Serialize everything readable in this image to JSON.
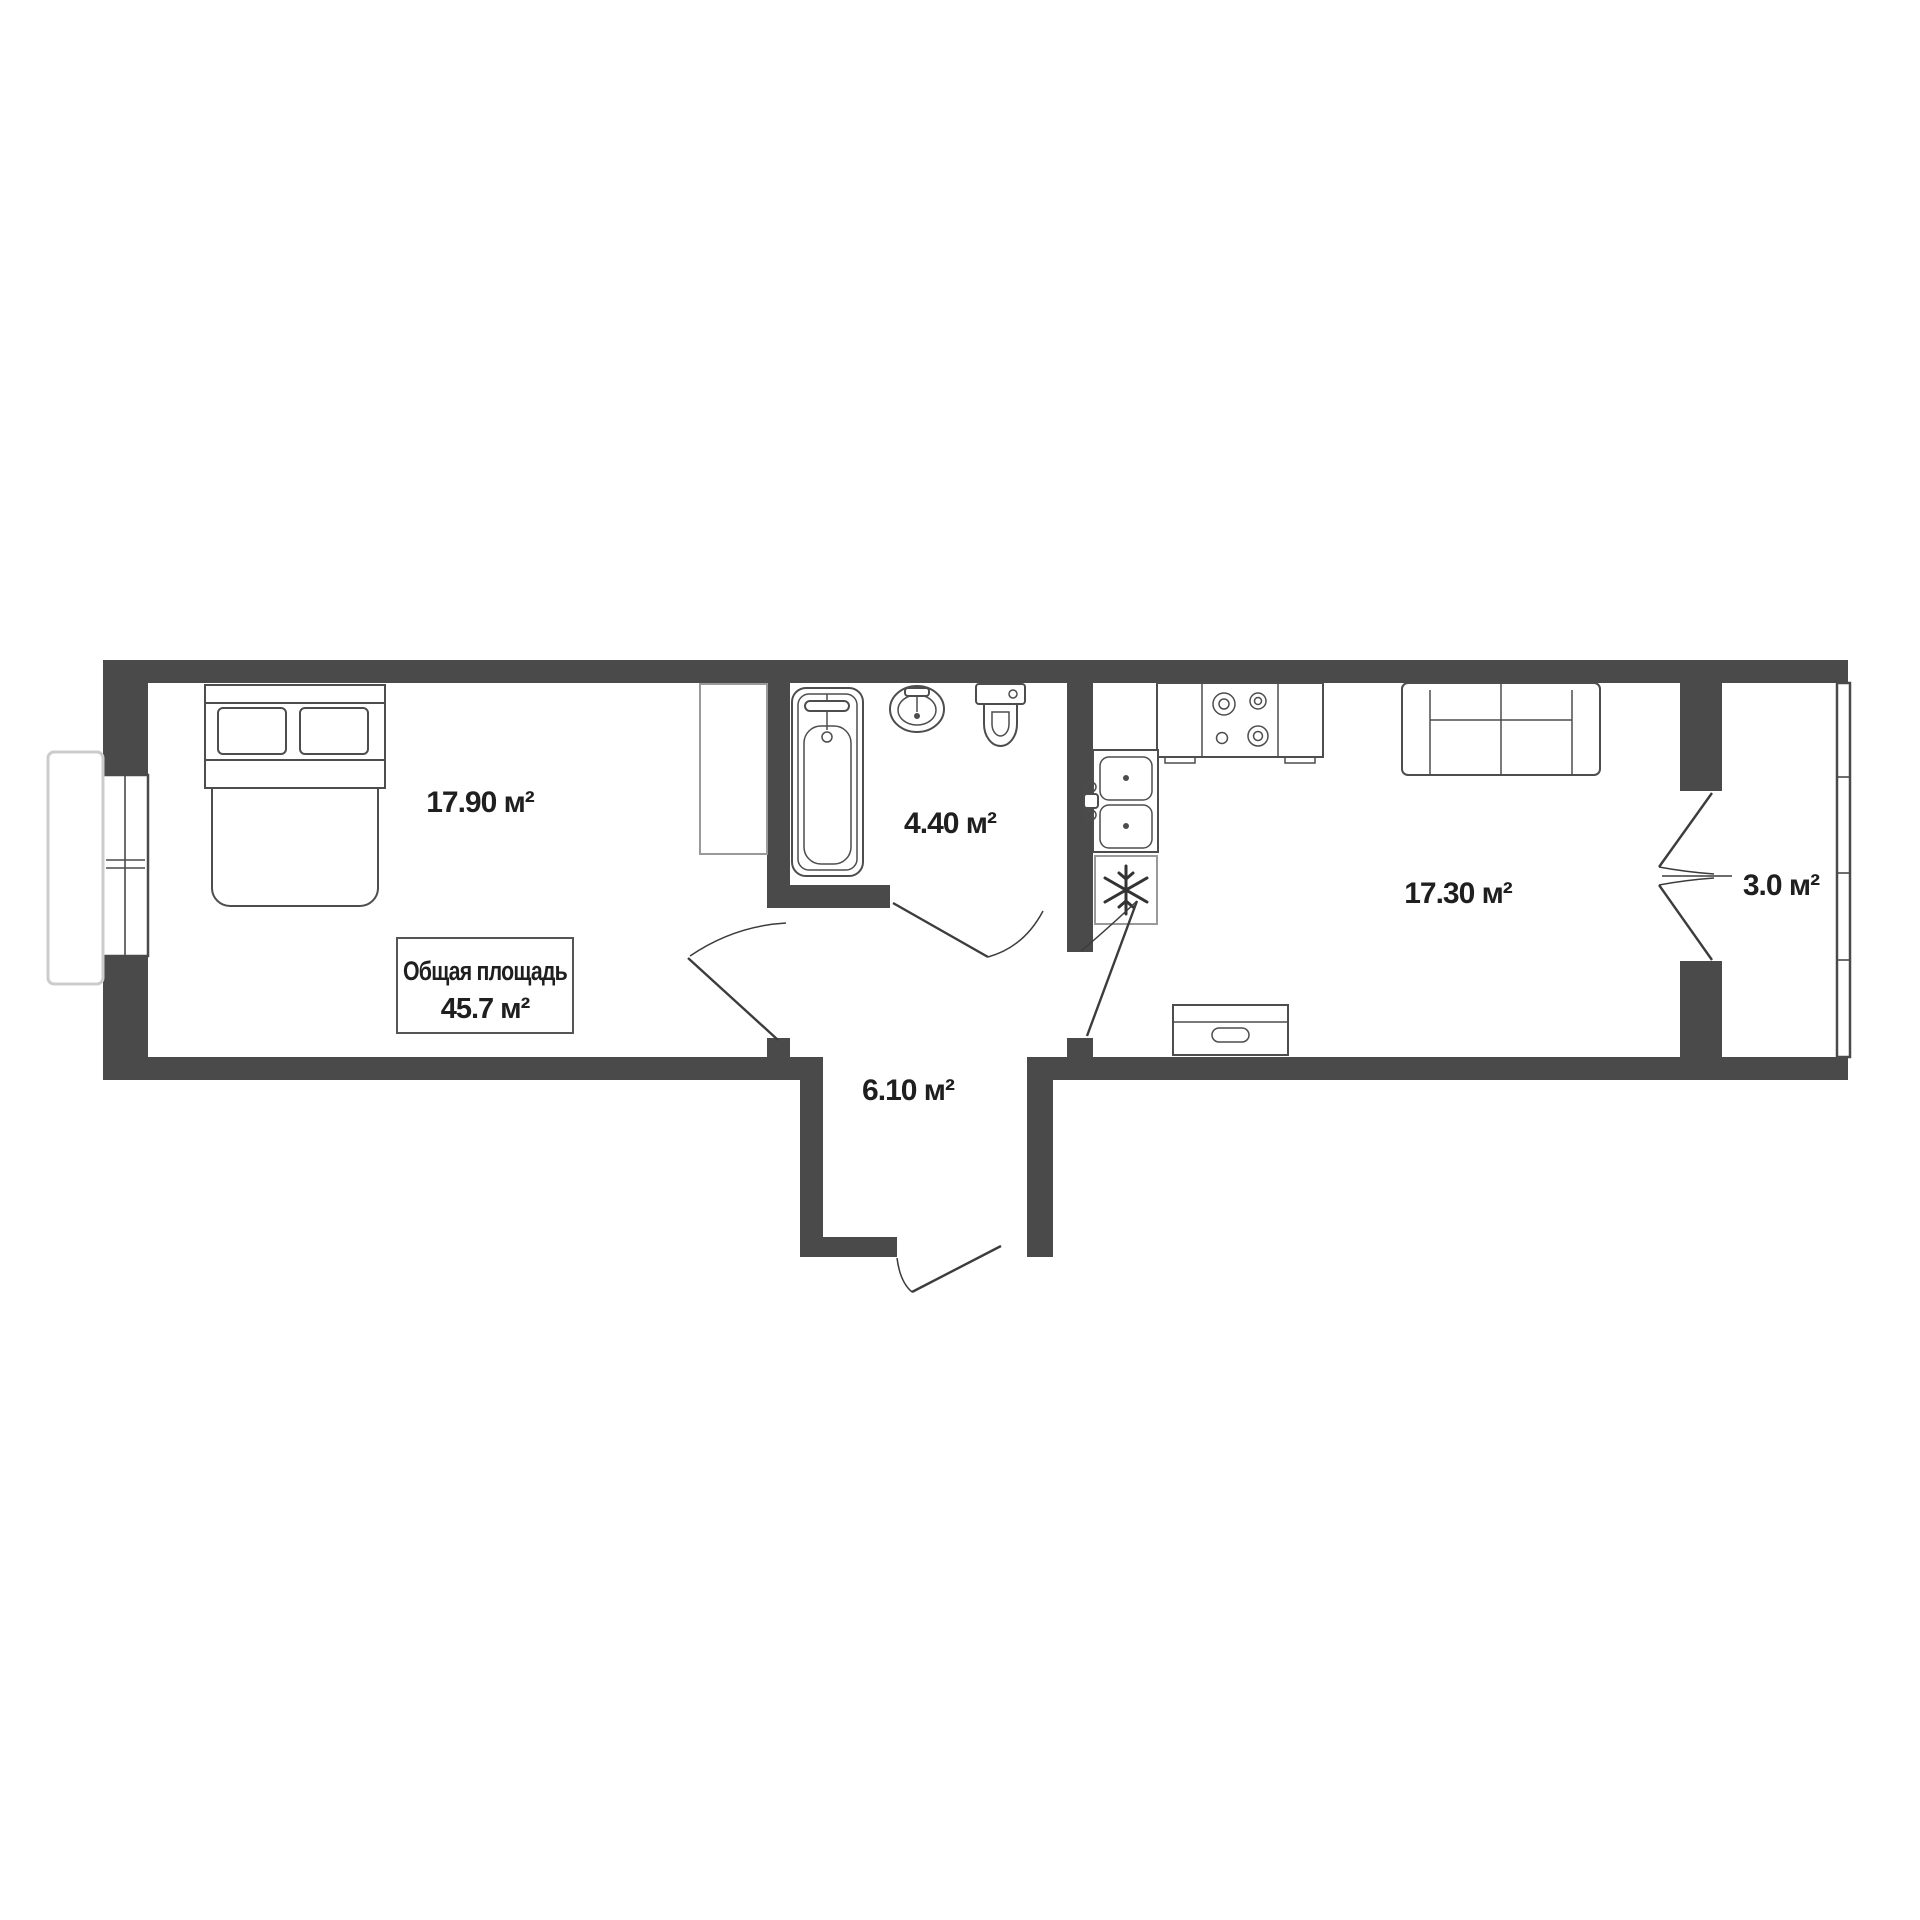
{
  "plan": {
    "total_area_box": {
      "title": "Общая площадь",
      "value": "45.7 м²"
    },
    "rooms": {
      "bedroom": {
        "area": "17.90 м²"
      },
      "bathroom": {
        "area": "4.40 м²"
      },
      "hallway": {
        "area": "6.10 м²"
      },
      "kitchen_living": {
        "area": "17.30 м²"
      },
      "balcony": {
        "area": "3.0 м²"
      }
    },
    "colors": {
      "wall": "#4a4a4a",
      "furniture_outline": "#4d4d4d",
      "ghost_outline": "#cccccc",
      "label_text": "#1f1f1f"
    }
  }
}
